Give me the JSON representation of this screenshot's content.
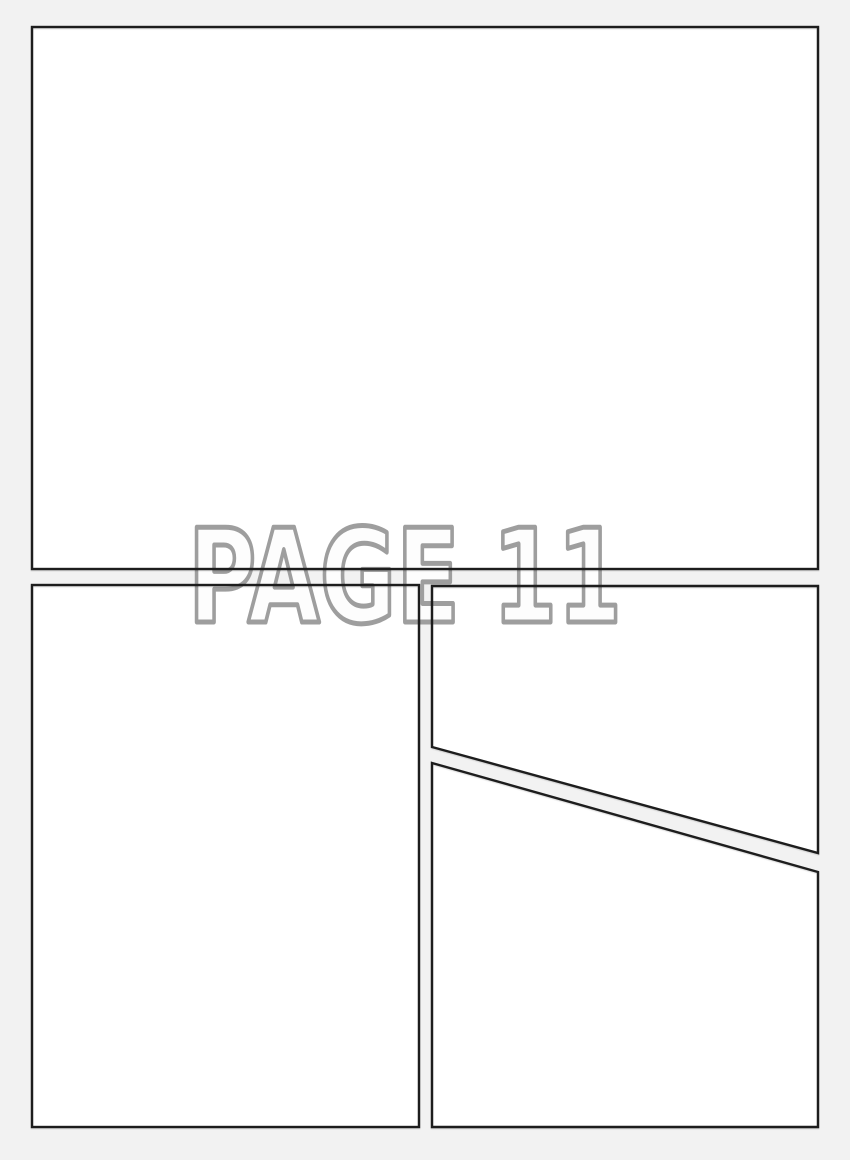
{
  "watermark": {
    "text": "PAGE 11"
  },
  "colors": {
    "page_background": "#f2f2f2",
    "panel_fill": "#ffffff",
    "panel_border": "#1d1d1d",
    "watermark_fill": "#fdfdfd",
    "watermark_outline": "#9e9e9e"
  }
}
